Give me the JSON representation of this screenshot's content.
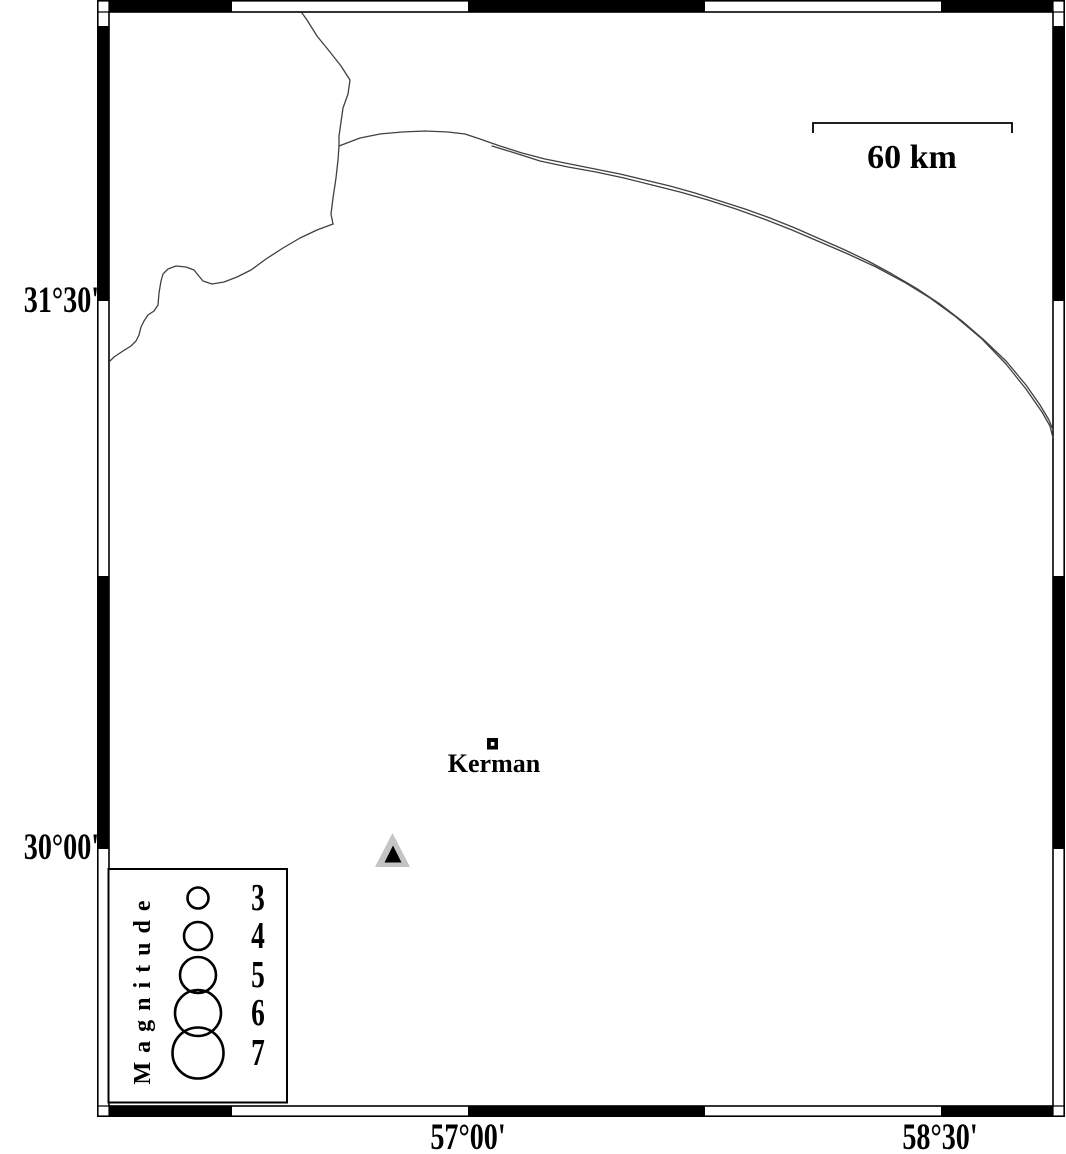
{
  "map": {
    "lat_labels": [
      {
        "text": "31°30'"
      },
      {
        "text": "30°00'"
      }
    ],
    "lon_labels": [
      {
        "text": "57°00'"
      },
      {
        "text": "58°30'"
      }
    ],
    "scale_bar_label": "60 km",
    "city_label": "Kerman",
    "legend": {
      "title": "Magnitude",
      "entries": [
        {
          "magnitude": "3"
        },
        {
          "magnitude": "4"
        },
        {
          "magnitude": "5"
        },
        {
          "magnitude": "6"
        },
        {
          "magnitude": "7"
        }
      ]
    },
    "markers": {
      "city": {
        "symbol": "open-square",
        "label": "Kerman"
      },
      "station": {
        "symbol": "gray-triangle"
      }
    },
    "colors": {
      "ink": "#000000",
      "boundary_line": "#404040",
      "station_gray": "#c4c4c4",
      "background": "#ffffff"
    }
  }
}
